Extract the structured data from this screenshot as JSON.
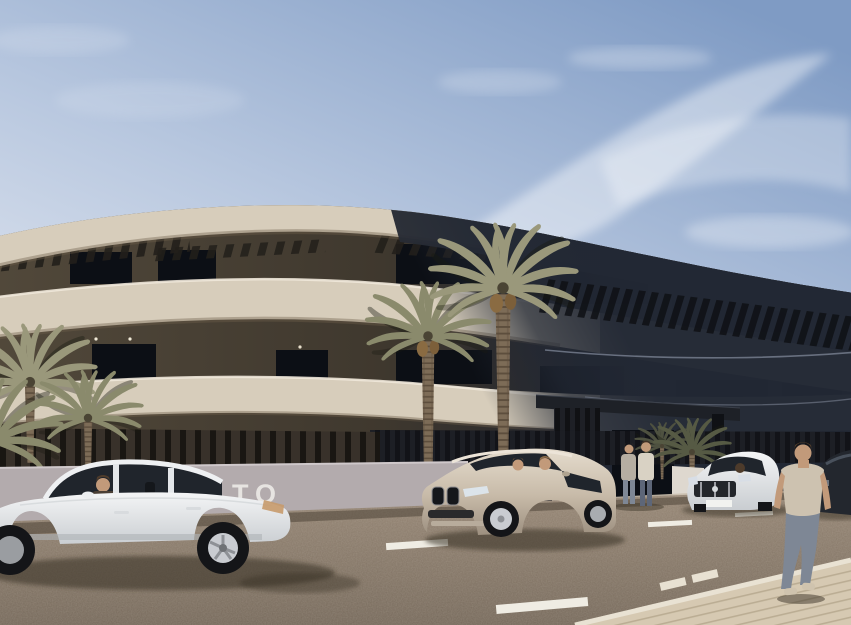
{
  "meta": {
    "description": "Sunny architectural rendering of a curved modern apartment building with cream balcony bands, a dark shadowed wing, palm trees, parked cars and pedestrians on a street"
  },
  "wall_sign": {
    "partial_text": "TO"
  },
  "colors": {
    "sky_top": "#7f9bc4",
    "sky_mid": "#bac9e0",
    "sky_low": "#e6eaf2",
    "cloud": "#ffffff",
    "facade_cream": "#d7cdbb",
    "facade_cream_bright": "#f0e8da",
    "facade_cream_shade": "#6e604c",
    "recess_left": "#51483a",
    "recess_mid": "#3f382e",
    "recess_right": "#1d212c",
    "roof_dark": "#272b35",
    "facade_shadow": "#222834",
    "window_glass": "#0c0f15",
    "pergola_slat": "#221f1a",
    "pergola_slat_dark": "#0e1014",
    "canopy": "#1e2127",
    "fence_base": "#38312a",
    "fence_bar": "#16130f",
    "fence_right_base": "#121318",
    "fence_right_bar": "#22242b",
    "low_wall": "#b3abad",
    "wall_text": "#eae8e4",
    "planter_white": "#ded8cf",
    "entrance_paving": "#c9beac",
    "road_top": "#958574",
    "road_bottom": "#75685a",
    "road_shadow": "#3f362b",
    "car_shadow": "#352d22",
    "lane_marking": "#efece3",
    "sidewalk": "#d6c9b2",
    "sidewalk_line": "#b4a68c",
    "curb": "#e9e2d3",
    "palm_lit": "#9a987b",
    "palm_mid": "#8a8a6c",
    "palm_dark": "#565a44",
    "palm_shadow": "#4e5140",
    "palm_trunk": "#7d6c57",
    "car_white_hi": "#f4f5f6",
    "car_white_lo": "#c9cdd1",
    "suv_hi": "#e5dccd",
    "suv_lo": "#9d9080",
    "car_dark": "#23272e",
    "glass": "#20252c",
    "tire": "#141518",
    "rim": "#c9ccd1",
    "skin": "#c29a7a",
    "hair": "#4d3b2b",
    "shirt_beige": "#cdc2b0",
    "jeans": "#7e8795",
    "woman_top": "#b6aea2",
    "man_top": "#d9d2c4",
    "jeans_dark": "#5d6678"
  },
  "vehicles": [
    {
      "name": "white sedan, side view, driver visible"
    },
    {
      "name": "champagne SUV, front three-quarter, two occupants"
    },
    {
      "name": "white sedan (Mercedes-style), front view, driver visible"
    },
    {
      "name": "dark car, partially visible at right edge"
    }
  ],
  "people": [
    {
      "name": "standing woman near entrance"
    },
    {
      "name": "standing man near entrance"
    },
    {
      "name": "man walking away on right, beige t-shirt and jeans"
    }
  ],
  "landscape": {
    "large_palms": 2,
    "small_palm_clusters": 2
  }
}
